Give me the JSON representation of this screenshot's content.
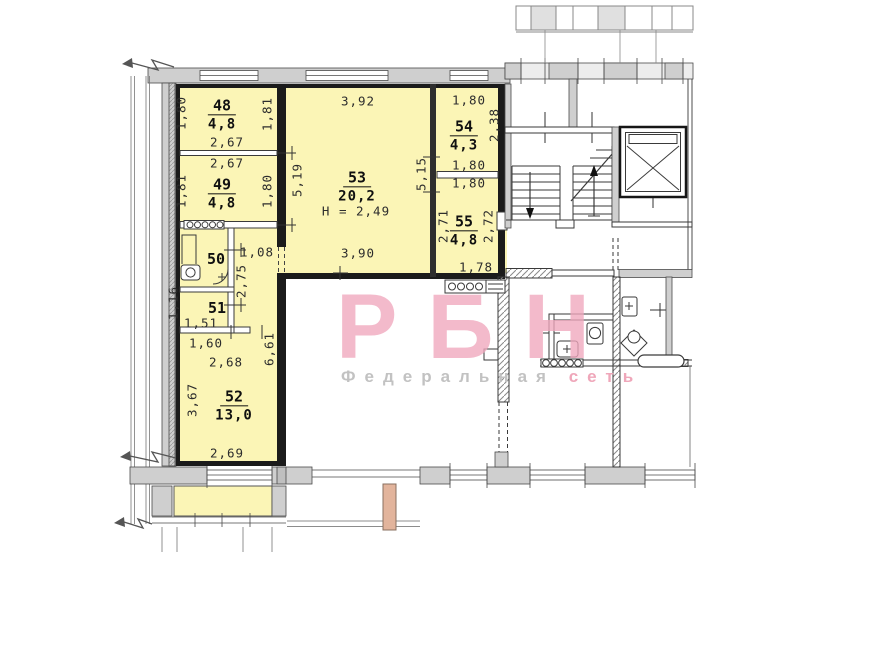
{
  "watermark": {
    "logo": "РБН",
    "tagline": [
      "Федеральная",
      "сеть"
    ]
  },
  "rooms": [
    {
      "number": "48",
      "area": "4,8",
      "dims": [
        "1,80",
        "1,81",
        "2,67"
      ]
    },
    {
      "number": "49",
      "area": "4,8",
      "dims": [
        "2,67",
        "1,81",
        "1,80"
      ]
    },
    {
      "number": "50",
      "dims": [
        "1,08",
        "2,75"
      ]
    },
    {
      "number": "51",
      "dims": [
        "1,16",
        "1,51"
      ]
    },
    {
      "number": "52",
      "area": "13,0",
      "dims": [
        "1,60",
        "2,68",
        "6,61",
        "3,67",
        "2,69"
      ]
    },
    {
      "number": "53",
      "area": "20,2",
      "height_note": "H = 2,49",
      "dims": [
        "3,92",
        "5,19",
        "3,90",
        "5,15"
      ]
    },
    {
      "number": "54",
      "area": "4,3",
      "dims": [
        "1,80",
        "2,38",
        "1,80"
      ]
    },
    {
      "number": "55",
      "area": "4,8",
      "dims": [
        "1,80",
        "2,71",
        "2,72",
        "1,78"
      ]
    }
  ],
  "colors": {
    "room_fill": "#FBF5B6",
    "wall_gray": "#CFCFCF",
    "outline": "#1B1B1B",
    "pillar": "#E2B49C",
    "watermark_pink": "#EFA6BC",
    "watermark_text_gray": "#C2C2C2"
  }
}
